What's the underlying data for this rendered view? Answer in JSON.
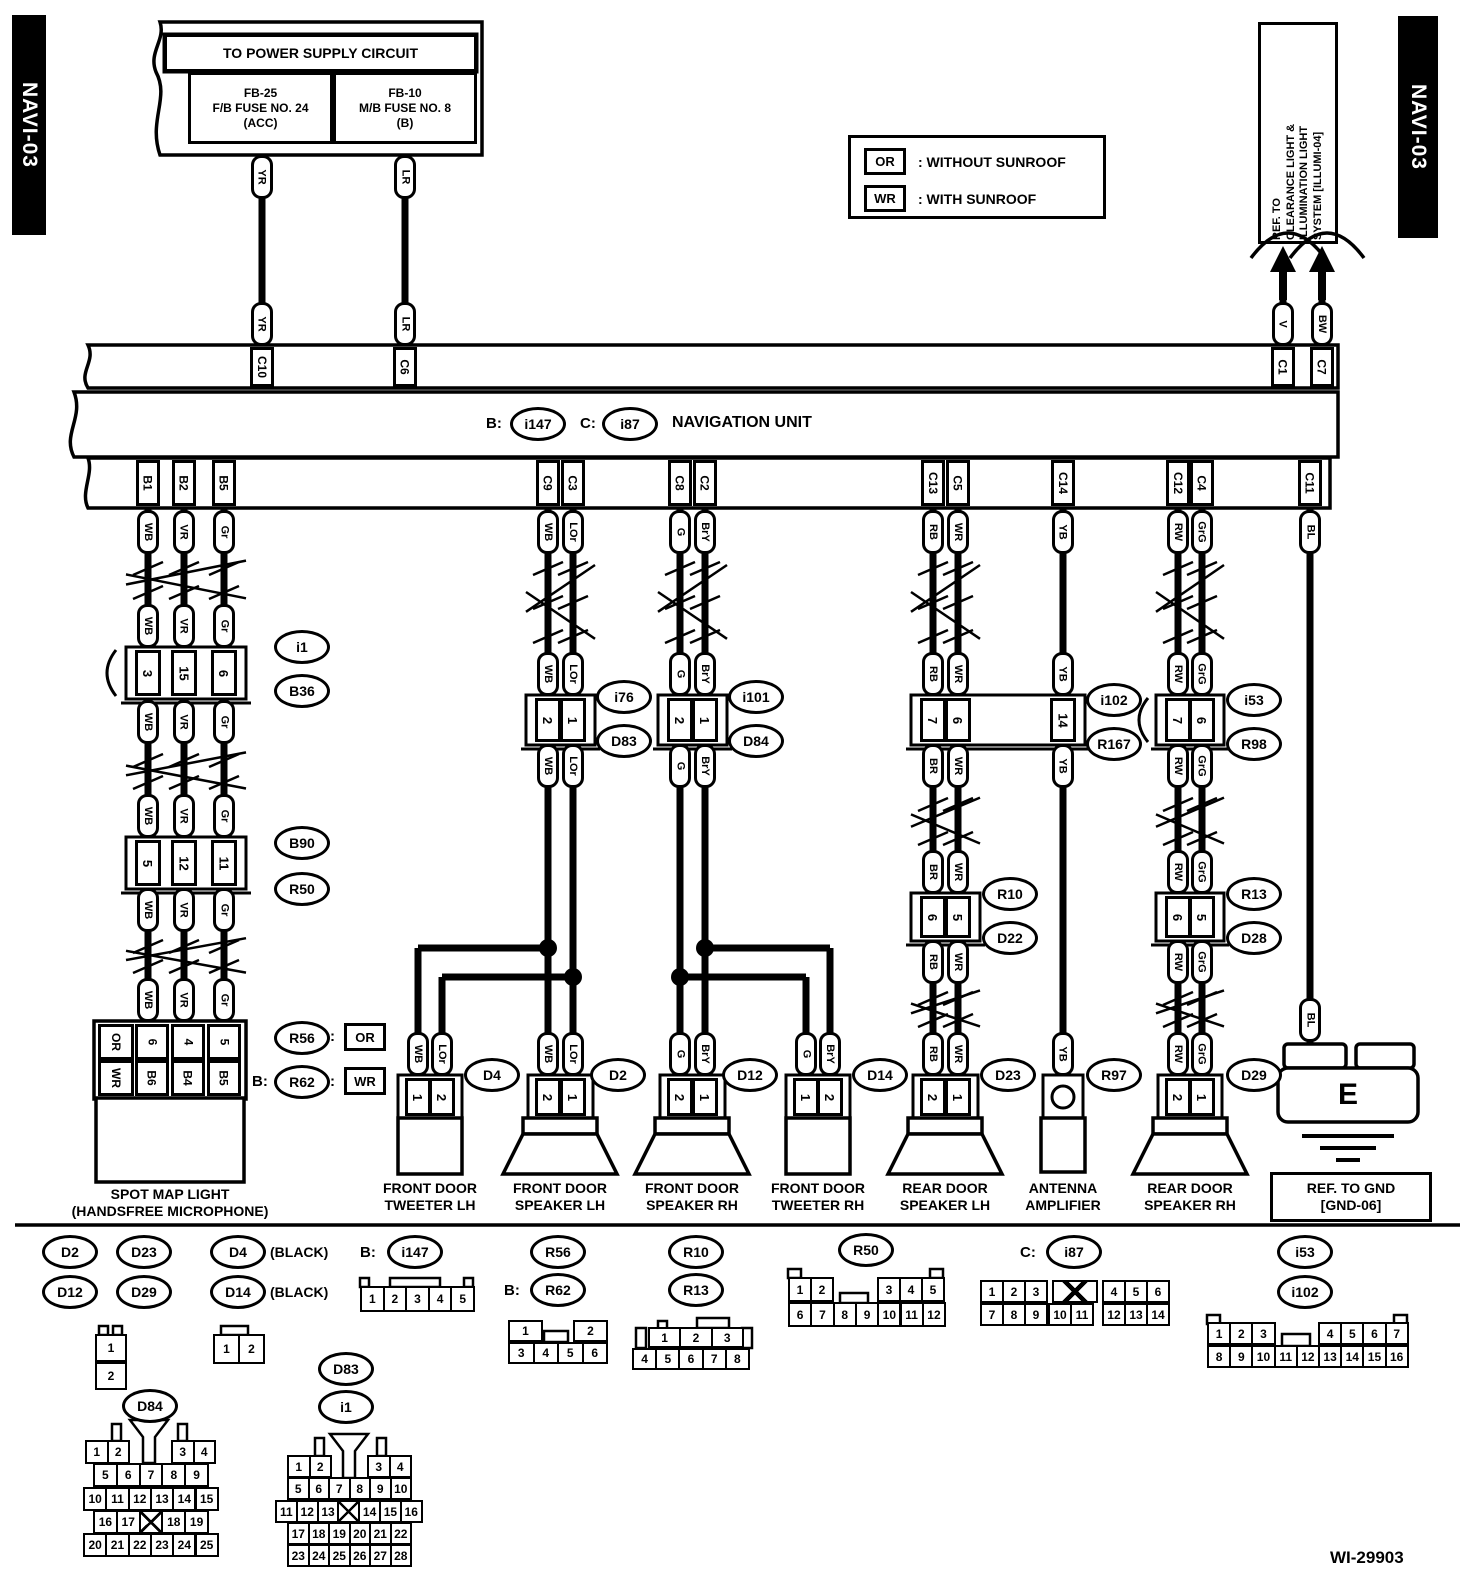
{
  "header": {
    "navi_left": "NAVI-03",
    "navi_right": "NAVI-03",
    "power_supply": {
      "title": "TO POWER SUPPLY CIRCUIT",
      "fuse_left": [
        "FB-25",
        "F/B FUSE NO. 24",
        "(ACC)"
      ],
      "fuse_right": [
        "FB-10",
        "M/B FUSE NO. 8",
        "(B)"
      ]
    },
    "legend": [
      {
        "code": "OR",
        "text": ": WITHOUT SUNROOF"
      },
      {
        "code": "WR",
        "text": ": WITH SUNROOF"
      }
    ],
    "ref_illumination": [
      "REF. TO",
      "CLEARANCE LIGHT &",
      "ILLUMINATION LIGHT",
      "SYSTEM [ILLUMI-04]"
    ]
  },
  "nav_unit": {
    "b_prefix": "B:",
    "b": "i147",
    "c_prefix": "C:",
    "c": "i87",
    "title": "NAVIGATION UNIT"
  },
  "wires": {
    "yr": "YR",
    "lr": "LR",
    "v": "V",
    "bw": "BW",
    "wb": "WB",
    "vr": "VR",
    "gr": "Gr",
    "lor": "LOr",
    "g": "G",
    "bry": "BrY",
    "rb": "RB",
    "br": "BR",
    "wr": "WR",
    "yb": "YB",
    "rw": "RW",
    "grg": "GrG",
    "bl": "BL"
  },
  "band_pins": {
    "c10": "C10",
    "c6": "C6",
    "c1": "C1",
    "c7": "C7",
    "b1": "B1",
    "b2": "B2",
    "b5": "B5",
    "c9": "C9",
    "c3": "C3",
    "c8": "C8",
    "c2": "C2",
    "c13": "C13",
    "c5": "C5",
    "c14": "C14",
    "c12": "C12",
    "c4": "C4",
    "c11": "C11"
  },
  "connectors": {
    "i1": "i1",
    "b36": "B36",
    "b90": "B90",
    "r50": "R50",
    "r56": "R56",
    "r62": "R62",
    "i76": "i76",
    "d83": "D83",
    "i101": "i101",
    "d84": "D84",
    "i102": "i102",
    "r167": "R167",
    "r10": "R10",
    "d22": "D22",
    "i53": "i53",
    "r98": "R98",
    "r13": "R13",
    "d28": "D28",
    "d4": "D4",
    "d2": "D2",
    "d12": "D12",
    "d14": "D14",
    "d23": "D23",
    "r97": "R97",
    "d29": "D29",
    "i147": "i147",
    "i87": "i87"
  },
  "pins": {
    "i1_b36": [
      "3",
      "15",
      "6"
    ],
    "b90_r50": [
      "5",
      "12",
      "11"
    ],
    "spot": {
      "row_codes": [
        "OR",
        "WR"
      ],
      "rows": [
        [
          "6",
          "4",
          "5"
        ],
        [
          "B6",
          "B4",
          "B5"
        ]
      ]
    },
    "i76_d83": [
      "2",
      "1"
    ],
    "i101_d84": [
      "2",
      "1"
    ],
    "i102_r167": [
      "7",
      "6",
      "14"
    ],
    "i53_r98": [
      "7",
      "6"
    ],
    "r10_d22": [
      "6",
      "5"
    ],
    "r13_d28": [
      "6",
      "5"
    ],
    "d4": [
      "1",
      "2"
    ],
    "d2": [
      "2",
      "1"
    ],
    "d12": [
      "2",
      "1"
    ],
    "d14": [
      "1",
      "2"
    ],
    "d23": [
      "2",
      "1"
    ],
    "d29": [
      "2",
      "1"
    ]
  },
  "sunroof_notes": {
    "colon": ":",
    "r56_code": "OR",
    "r62_prefix": "B:",
    "r62_code": "WR"
  },
  "components": {
    "spot": [
      "SPOT MAP LIGHT",
      "(HANDSFREE MICROPHONE)"
    ],
    "tweeter_lh": [
      "FRONT DOOR",
      "TWEETER LH"
    ],
    "speaker_lh": [
      "FRONT DOOR",
      "SPEAKER LH"
    ],
    "speaker_rh": [
      "FRONT DOOR",
      "SPEAKER RH"
    ],
    "tweeter_rh": [
      "FRONT DOOR",
      "TWEETER RH"
    ],
    "rear_lh": [
      "REAR DOOR",
      "SPEAKER LH"
    ],
    "antenna": [
      "ANTENNA",
      "AMPLIFIER"
    ],
    "rear_rh": [
      "REAR DOOR",
      "SPEAKER RH"
    ]
  },
  "ground": {
    "label": "E",
    "ref": [
      "REF. TO GND",
      "[GND-06]"
    ]
  },
  "bottom": {
    "black_note": "(BLACK)",
    "b_prefix": "B:",
    "c_prefix": "C:",
    "pinouts": {
      "d_pair": [
        [
          "1"
        ],
        [
          "2"
        ]
      ],
      "d4_d14": [
        [
          "1",
          "2"
        ]
      ],
      "i147": [
        [
          "1",
          "2",
          "3",
          "4",
          "5"
        ]
      ],
      "r56_r62": [
        [
          "1",
          "~",
          "2"
        ],
        [
          "3",
          "4",
          "5",
          "6"
        ]
      ],
      "r10_r13": [
        [
          "1",
          "2",
          "3"
        ],
        [
          "4",
          "5",
          "6",
          "7",
          "8"
        ]
      ],
      "r50": [
        [
          "1",
          "2",
          "~",
          "3",
          "4",
          "5"
        ],
        [
          "6",
          "7",
          "8",
          "9",
          "10",
          "11",
          "12"
        ]
      ],
      "i87": [
        [
          "1",
          "2",
          "3",
          "X",
          "4",
          "5",
          "6"
        ],
        [
          "7",
          "8",
          "9",
          "10",
          "11",
          "12",
          "13",
          "14"
        ]
      ],
      "i53_i102": [
        [
          "1",
          "2",
          "3",
          "~",
          "4",
          "5",
          "6",
          "7"
        ],
        [
          "8",
          "9",
          "10",
          "11",
          "12",
          "13",
          "14",
          "15",
          "16"
        ]
      ],
      "d84": [
        [
          "1",
          "2",
          "~",
          "3",
          "4"
        ],
        [
          "5",
          "6",
          "7",
          "8",
          "9"
        ],
        [
          "10",
          "11",
          "12",
          "13",
          "14",
          "15"
        ],
        [
          "16",
          "17",
          "X",
          "18",
          "19"
        ],
        [
          "20",
          "21",
          "22",
          "23",
          "24",
          "25"
        ]
      ],
      "d83_i1": [
        [
          "1",
          "2",
          "~",
          "3",
          "4"
        ],
        [
          "5",
          "6",
          "7",
          "8",
          "9",
          "10"
        ],
        [
          "11",
          "12",
          "13",
          "X",
          "14",
          "15",
          "16"
        ],
        [
          "17",
          "18",
          "19",
          "20",
          "21",
          "22"
        ],
        [
          "23",
          "24",
          "25",
          "26",
          "27",
          "28"
        ]
      ]
    }
  },
  "footer": "WI-29903"
}
